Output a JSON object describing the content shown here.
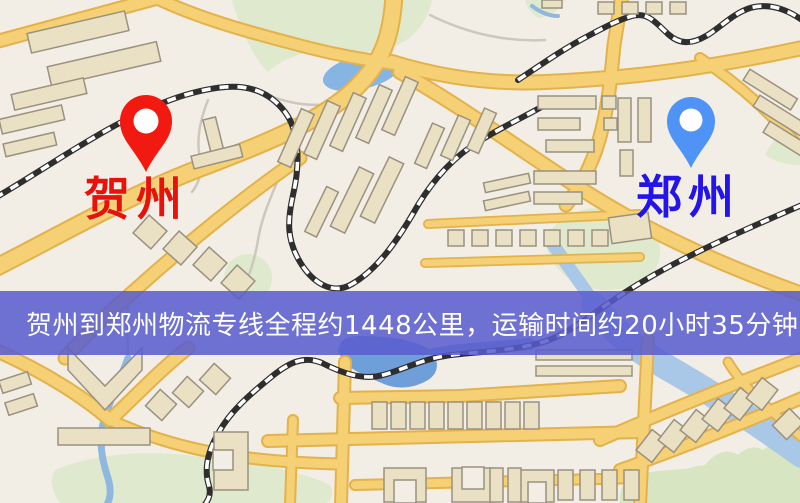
{
  "map": {
    "markers": [
      {
        "id": "origin",
        "name": "贺州",
        "pin_color": "#f21a10",
        "label_color": "#e8120a"
      },
      {
        "id": "destination",
        "name": "郑州",
        "pin_color": "#4f93f7",
        "label_color": "#2414ea"
      }
    ],
    "banner": {
      "text": "贺州到郑州物流专线全程约1448公里，运输时间约20小时35分钟.",
      "bg_color": "#585cce",
      "text_color": "#ffffff"
    },
    "palette": {
      "background": "#f2eee5",
      "road_fill": "#f5d075",
      "road_edge": "#e3b24c",
      "building_fill": "#eae0c3",
      "building_outline": "#9a9180",
      "park_green": "#dfe9cd",
      "hill_green": "#d8e5c2",
      "pond_water": "#86b5e3",
      "river_water": "#a9c7e6",
      "deep_water": "#6f9fd8",
      "railway_dark": "#2e2e2e",
      "railway_light": "#ffffff"
    }
  }
}
